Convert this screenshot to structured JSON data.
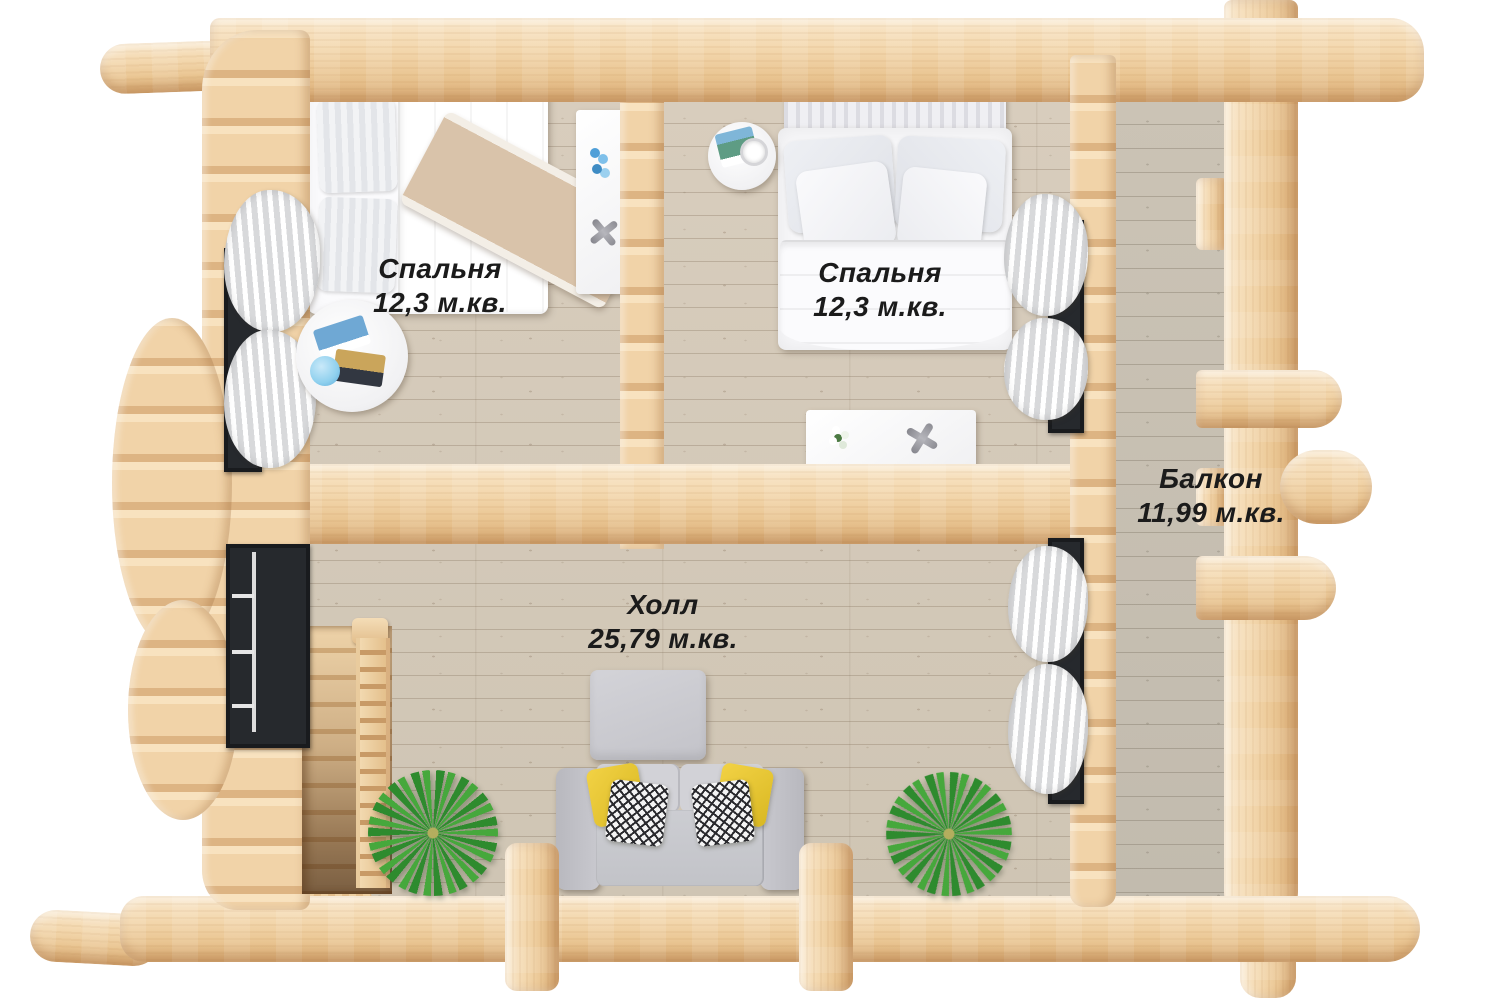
{
  "labels": {
    "bedroom_left": {
      "name": "Спальня",
      "area": "12,3 м.кв."
    },
    "bedroom_right": {
      "name": "Спальня",
      "area": "12,3 м.кв."
    },
    "hall": {
      "name": "Холл",
      "area": "25,79 м.кв."
    },
    "balcony": {
      "name": "Балкон",
      "area": "11,99 м.кв."
    }
  },
  "colors": {
    "background": "#ffffff",
    "log_wood_light": "#f7e3c3",
    "log_wood_mid": "#f0d2a6",
    "log_wood_dark": "#d9ae78",
    "floor_plank": "#d4caba",
    "balcony_floor": "#c9c1b3",
    "label_text": "#1b1b1b",
    "sofa_gray": "#c9c9ce",
    "pillow_yellow": "#e9c832",
    "plant_green": "#2f8f2f",
    "window_black": "#2c2f33",
    "bedding_white": "#f7f7f9",
    "blanket_beige": "#dbc5ac"
  }
}
